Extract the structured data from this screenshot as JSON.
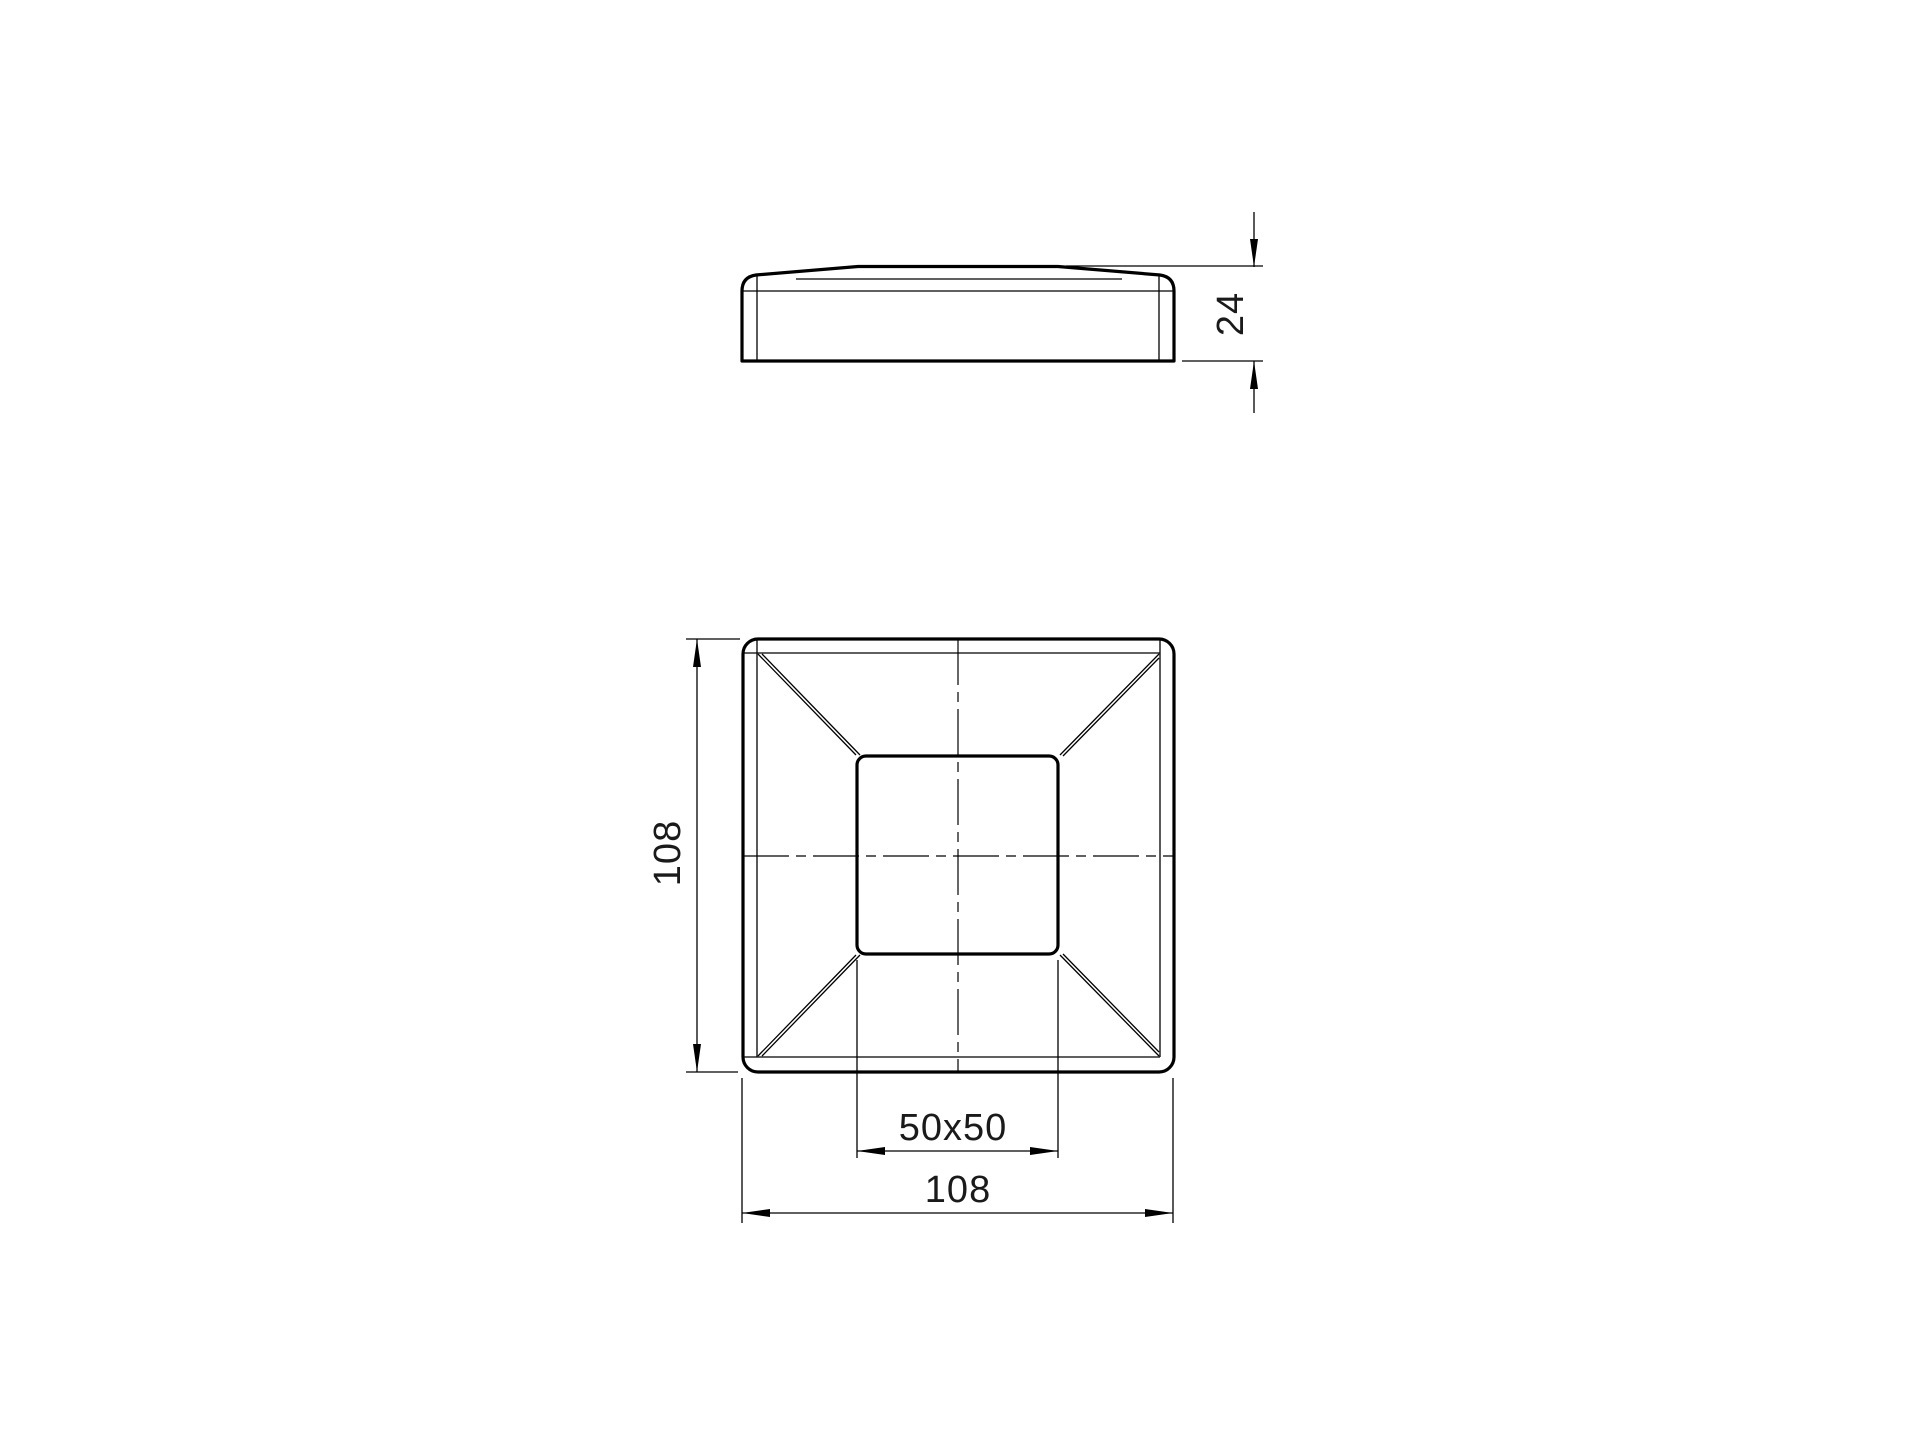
{
  "drawing": {
    "background_color": "#ffffff",
    "line_color": "#000000",
    "text_color": "#1a1a1a",
    "views": {
      "side_view": "side elevation of cap",
      "top_view": "plan view of cap"
    },
    "dimensions": {
      "cap_height": "24",
      "overall_height": "108",
      "inner_square": "50x50",
      "overall_width": "108"
    }
  }
}
